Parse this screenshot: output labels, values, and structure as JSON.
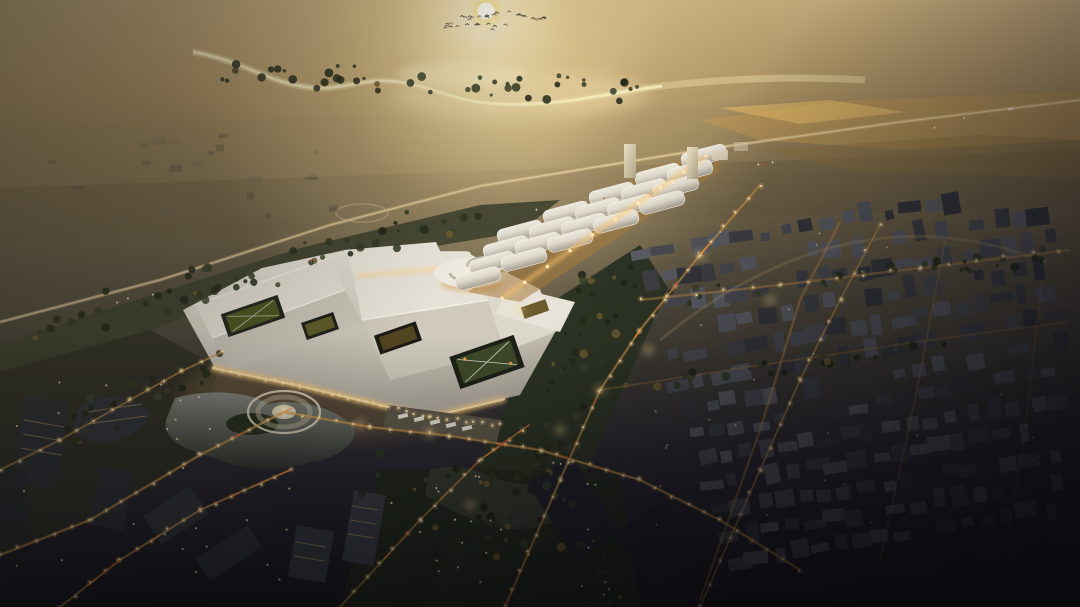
{
  "meta": {
    "content_type": "aerial architectural rendering",
    "subject": "exhibition-center masterplan at golden-hour haze",
    "visible_text": "none"
  },
  "palette": {
    "sun_core": "#fffdf2",
    "sun_rim": "#f6d96a",
    "sky_glow": "#ffeec2",
    "haze_gold": "#c7ab7a",
    "haze_dark": "#4c4739",
    "night_ground": "#17161c",
    "river_light": "#efdfae",
    "field_gold": "#c59a52",
    "roof_light": "#ece8dd",
    "roof_shade": "#b3ada0",
    "vault_light": "#e8e4d9",
    "vault_shade": "#a39d8f",
    "facade_glow": "#f7c97a",
    "street_glow": "#ffc56a",
    "light_dot": "#ffe9b8",
    "light_halo": "#ffcf7a",
    "car_trail": "#ff8f3a",
    "car_red": "#e0502a",
    "courtyard_green": "#44511f",
    "tree_dark": "#2a3120",
    "belt_green": "#2d3424",
    "block_gray": "#4a4c53",
    "block_dark": "#34363c",
    "campus_dark": "#2b2e33",
    "lake_top": "#82867c",
    "lake_bottom": "#31342e",
    "bird": "#3a3a33"
  },
  "scene": {
    "elements": [
      {
        "name": "sun",
        "desc": "low sun disc in golden haze, top center"
      },
      {
        "name": "bird-flock",
        "desc": "flock of small birds below the sun"
      },
      {
        "name": "river",
        "desc": "winding reflective river in hazy distance"
      },
      {
        "name": "farm-fields",
        "desc": "golden fields upper right with highway"
      },
      {
        "name": "exhibition-complex",
        "desc": "large white-roofed exhibition halls with green courtyards"
      },
      {
        "name": "vaulted-hall-rows",
        "desc": "grid of barrel-vaulted halls extending to upper right"
      },
      {
        "name": "ring-building",
        "desc": "circular white ring hall at complex center"
      },
      {
        "name": "roundabout",
        "desc": "circular plaza with fountain, lower left of complex"
      },
      {
        "name": "residential-district",
        "desc": "dark gray housing blocks right side"
      },
      {
        "name": "office-campus",
        "desc": "lit mid-rise offices and lake, lower left"
      },
      {
        "name": "road-network",
        "desc": "glowing warm streets with streetlights and car trails"
      }
    ]
  },
  "counts": {
    "birds": 38,
    "vaulted_halls": 20,
    "residential_rows": 13,
    "residential_cols": 20
  }
}
